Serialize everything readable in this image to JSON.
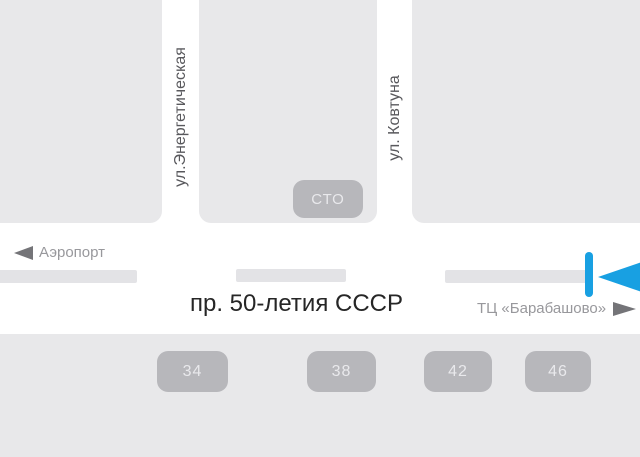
{
  "map": {
    "vertical_streets": [
      {
        "name": "ул.Энергетическая"
      },
      {
        "name": "ул. Ковтуна"
      }
    ],
    "main_road": {
      "name": "пр. 50-летия СССР"
    },
    "directions": {
      "left_label": "Аэропорт",
      "right_label": "ТЦ «Барабашово»"
    },
    "landmarks": {
      "service_station": "СТО"
    },
    "building_numbers": [
      "34",
      "38",
      "42",
      "46"
    ],
    "icons": {
      "left_direction_arrow": "triangle-left",
      "right_direction_arrow": "triangle-right",
      "marker_arrow": "triangle-left"
    },
    "colors": {
      "block_gray": "#e8e8ea",
      "badge_gray": "#b7b7bb",
      "lane_gray": "#e3e3e6",
      "text_gray": "#98989c",
      "street_text": "#58585c",
      "main_text": "#262626",
      "accent_blue": "#18a0e2"
    }
  }
}
